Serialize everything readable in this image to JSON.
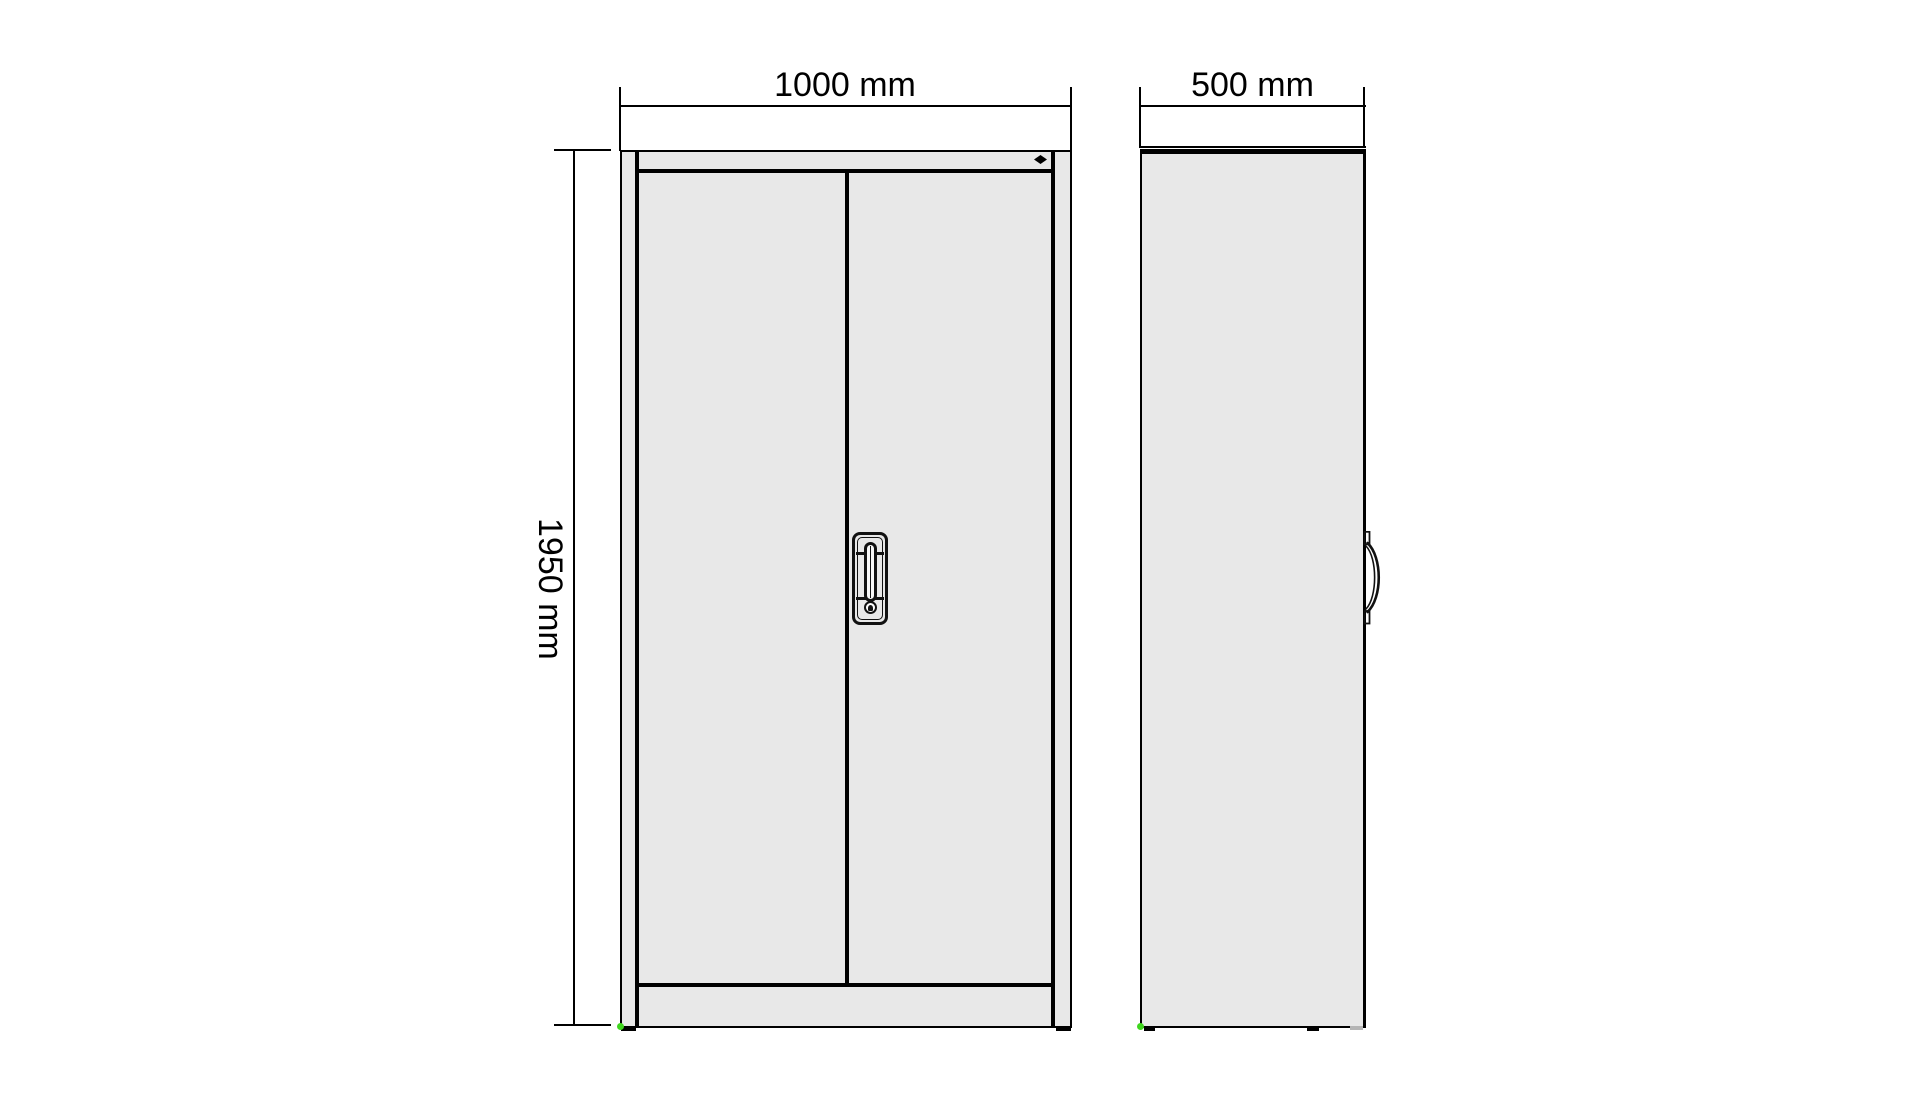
{
  "drawing": {
    "type": "technical-drawing",
    "subject": "two-door steel cabinet, front and side elevations",
    "dimensions": {
      "width": {
        "label": "1000 mm",
        "value_mm": 1000
      },
      "height": {
        "label": "1950 mm",
        "value_mm": 1950
      },
      "depth": {
        "label": "500 mm",
        "value_mm": 500
      }
    },
    "markers": {
      "lock_diamond": "black-diamond",
      "corner_marker": "green-dot"
    },
    "colors": {
      "bg": "#ffffff",
      "line": "#000000",
      "panel": "#e8e8e8",
      "marker": "#3fd61e"
    }
  }
}
